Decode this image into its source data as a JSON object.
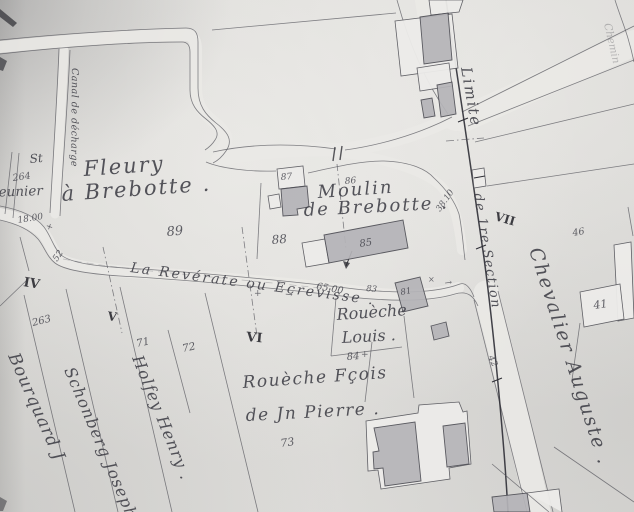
{
  "waterways": {
    "canal": "Canal de décharge",
    "stream": "La Revérate ou Ecrevisse ."
  },
  "places": {
    "fleury_line1": "Fleury",
    "fleury_line2": "à Brebotte .",
    "moulin_line1": "Moulin",
    "moulin_line2": "de Brebotte ."
  },
  "boundary": {
    "limite_line1": "Limite",
    "limite_line2": "de 1re Section"
  },
  "owners": {
    "st": "St",
    "meunier": "meunier",
    "bourquard": "Bourquard J",
    "schonberg": "Schonberg Joseph",
    "holfey": "Holfey Henry .",
    "rouesche_line1": "Rouèche",
    "rouesche_line2": "Louis .",
    "rouesche2_line1": "Rouèche Fçois",
    "rouesche2_line2": "de Jn Pierre .",
    "chevalier": "Chevalier Auguste .",
    "chemin": "Chemin"
  },
  "parcels": {
    "n41": "41",
    "n42": "42",
    "n46": "46",
    "n71": "71",
    "n72": "72",
    "n73": "73",
    "n81": "81",
    "n83": "83",
    "n84": "84",
    "n85": "85",
    "n86": "86",
    "n87": "87",
    "n88": "88",
    "n89": "89",
    "n263": "263",
    "n264": "264"
  },
  "measures": {
    "m18": "18.00",
    "m52": "52",
    "m65": "65.00",
    "m38": "38.10"
  },
  "romans": {
    "iv": "IV",
    "v": "V",
    "vi": "VI",
    "vii": "VII"
  },
  "glyphs": {
    "cross": "+",
    "arrow": "→",
    "x_mark": "×"
  },
  "colors": {
    "ink": "#3e3e46",
    "paper": "#d9d8d5",
    "building": "#b5b4b8",
    "light_building": "#edecea",
    "dark_line": "#2e2e35"
  }
}
